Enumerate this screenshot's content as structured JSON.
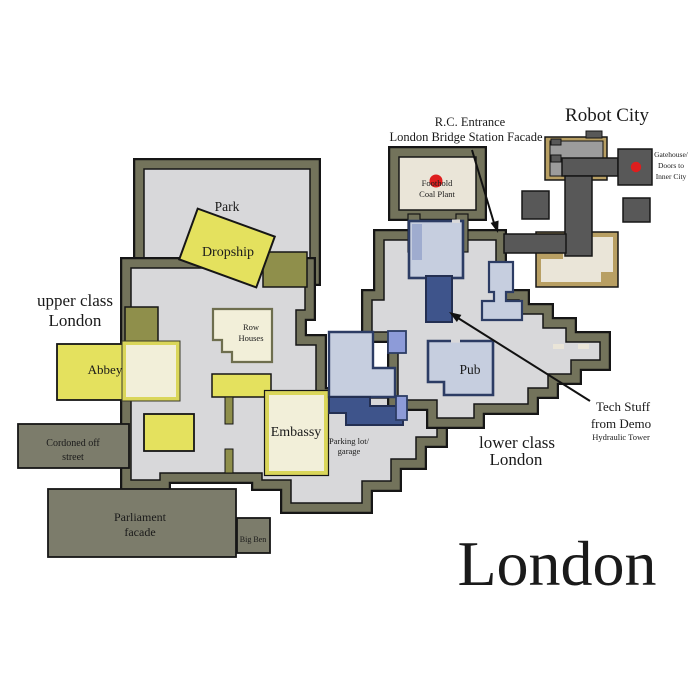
{
  "map": {
    "title": "London",
    "regions": {
      "upper_line1": "upper class",
      "upper_line2": "London",
      "lower_line1": "lower class",
      "lower_line2": "London",
      "robot_city": "Robot City"
    },
    "places": {
      "park": "Park",
      "dropship": "Dropship",
      "abbey": "Abbey",
      "row_houses_line1": "Row",
      "row_houses_line2": "Houses",
      "embassy": "Embassy",
      "pub": "Pub",
      "parking_line1": "Parking lot/",
      "parking_line2": "garage",
      "cordoned_line1": "Cordoned off",
      "cordoned_line2": "street",
      "parliament_line1": "Parliament",
      "parliament_line2": "facade",
      "big_ben": "Big Ben",
      "coal_plant_line1": "Foothold",
      "coal_plant_line2": "Coal Plant",
      "gatehouse_line1": "Gatehouse/",
      "gatehouse_line2": "Doors to",
      "gatehouse_line3": "Inner City"
    },
    "annotations": {
      "rc_entrance_line1": "R.C. Entrance",
      "rc_entrance_line2": "London Bridge Station Facade",
      "tech_line1": "Tech Stuff",
      "tech_line2": "from Demo",
      "hydraulic": "Hydraulic Tower"
    },
    "colors": {
      "wall": "#73735B",
      "interior": "#D8D8DA",
      "outline": "#161616",
      "gray_block": "#7C7C6B",
      "yellow": "#E4E15E",
      "olive": "#8F8F4B",
      "cream": "#F2EFD9",
      "embassy_border": "#DAD65A",
      "blue_light": "#C6CEDF",
      "blue_mid": "#9FACCF",
      "blue_dark": "#3E548B",
      "navy": "#2C3C64",
      "periwinkle": "#8D9BD8",
      "corridor_gray": "#585858",
      "robot_inner_gray": "#9C9C9C",
      "tan": "#B89F63",
      "beige": "#EAE5D8",
      "red_dot": "#DE1E1E"
    }
  }
}
